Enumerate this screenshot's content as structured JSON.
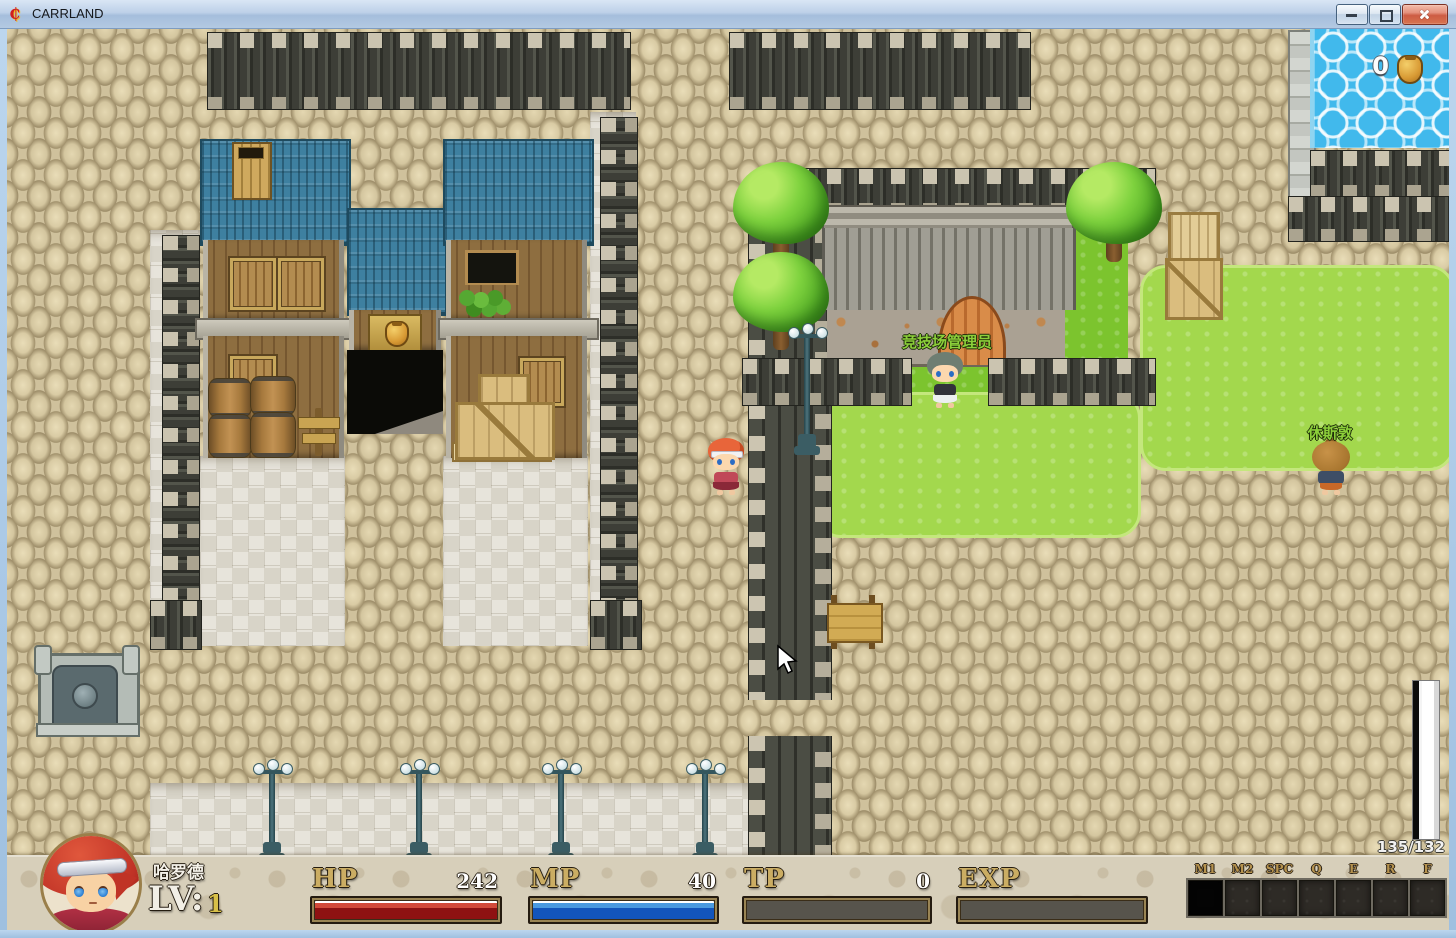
{
  "window": {
    "title": "CARRLAND",
    "controls": {
      "minimize": "minimize-icon",
      "maximize": "maximize-icon",
      "close": "close-icon"
    }
  },
  "map": {
    "gold_amount": "0",
    "gold_icon": "money-bag-icon",
    "labels": {
      "arena_manager": "竞技场管理员",
      "houston": "休斯敦"
    },
    "label_color": "#8ccf3a"
  },
  "hud": {
    "fps": "135/132",
    "character": {
      "name": "哈罗德",
      "level_label": "LV:",
      "level_value": "1"
    },
    "bars": {
      "hp": {
        "label": "HP",
        "value": "242",
        "fill_pct": 100,
        "stripe": "#d24a3a",
        "body": "#8e1212"
      },
      "mp": {
        "label": "MP",
        "value": "40",
        "fill_pct": 100,
        "stripe": "#4a9ae0",
        "body": "#1355bb"
      },
      "tp": {
        "label": "TP",
        "value": "0",
        "fill_pct": 0,
        "stripe": "#8a8a80",
        "body": "#5a574e"
      },
      "exp": {
        "label": "EXP",
        "value": "",
        "fill_pct": 0,
        "stripe": "#8a8a80",
        "body": "#5a574e"
      }
    },
    "hotkeys": [
      "M1",
      "M2",
      "SPC",
      "Q",
      "E",
      "R",
      "F"
    ]
  }
}
